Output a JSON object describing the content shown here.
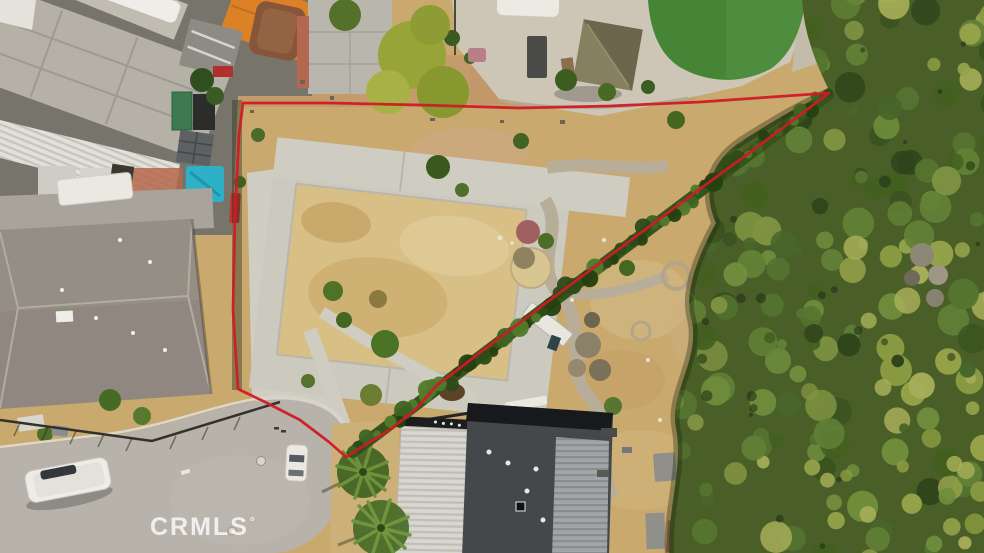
{
  "meta": {
    "type": "aerial-drone-photo",
    "subject": "vacant triangular land parcel outlined in red between homes and woodland",
    "width": 984,
    "height": 553
  },
  "watermark": {
    "text": "CRMLS",
    "registered_mark": "°"
  },
  "boundary": {
    "shape": "triangular parcel outline with rounded corner at cul-de-sac",
    "color": "#d01a26",
    "stroke_width": "2.7",
    "points": "346,457 329,442 300,420 263,401 238,389 233,310 235,215 239,135 243,103 330,103 420,105 520,108 610,106 700,102 829,93 772,136 700,189 627,243 554,297 490,345 452,374 437,385 417,408 391,429 365,445 346,457"
  },
  "palette": {
    "boundary-red": "#d01a26",
    "dirt-tan": "#c9a96e",
    "dirt-light": "#d9c28c",
    "dirt-red": "#c2946a",
    "concrete": "#d0cdc3",
    "pad-grass": "#d8bf86",
    "street-grey": "#b7b3ab",
    "forest-green": "#4a5e28",
    "hedge-green": "#35541c",
    "lawn-green": "#478536",
    "roof-dark": "#45484b",
    "roof-shingle": "#908880",
    "roof-white": "#dcd9d2",
    "roof-orange": "#dd8127",
    "roof-rust": "#86553a",
    "tarp-teal": "#2eb0c6",
    "watermark-white": "rgba(255,255,255,0.78)"
  }
}
